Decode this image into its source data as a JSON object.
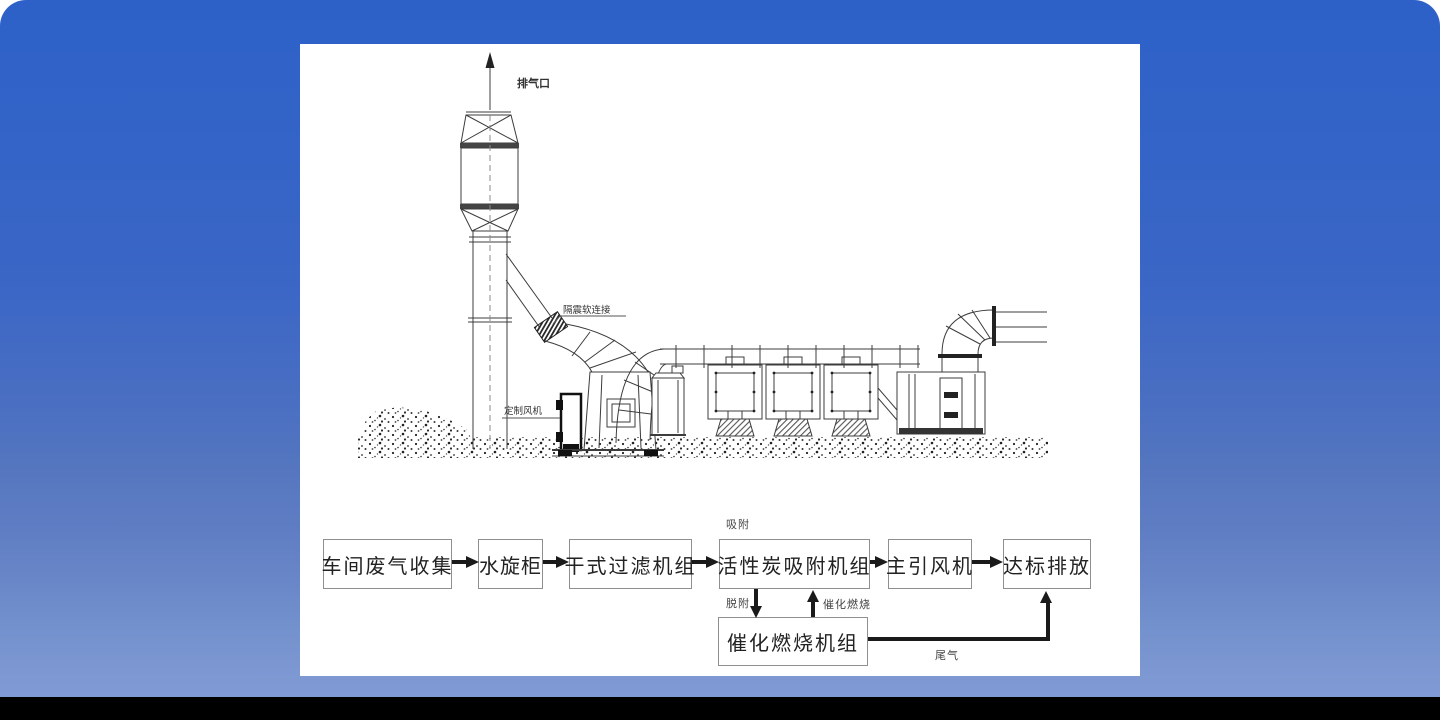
{
  "colors": {
    "background_top": "#2d61c8",
    "background_bottom": "#809ad4",
    "bottom_bar": "#000000",
    "panel": "#ffffff",
    "line": "#3c3c3c",
    "arrow": "#1a1a1a",
    "box_border": "#8f8f8f"
  },
  "diagram": {
    "outlet_label": "排气口",
    "flex_joint_label": "隔震软连接",
    "custom_fan_label": "定制风机"
  },
  "flowchart": {
    "boxes": [
      "车间废气收集",
      "水旋柜",
      "干式过滤机组",
      "活性炭吸附机组",
      "主引风机",
      "达标排放"
    ],
    "bottom_box_label": "催化燃烧机组",
    "adsorption_label": "吸附",
    "desorption_label": "脱附",
    "catalytic_combustion_label": "催化燃烧",
    "tail_gas_label": "尾气"
  }
}
